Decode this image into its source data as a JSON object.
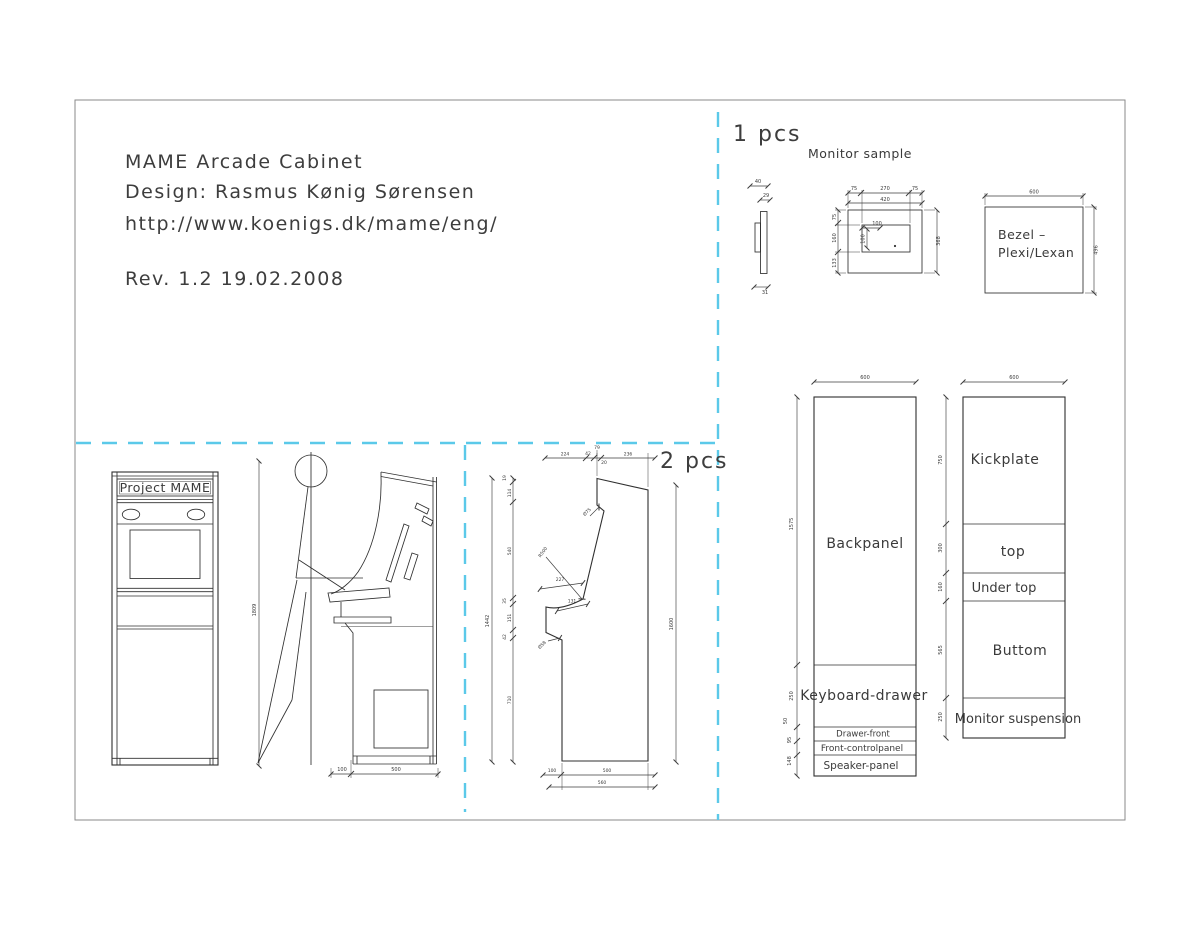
{
  "title_block": {
    "line1": "MAME Arcade Cabinet",
    "line2": "Design: Rasmus Kønig Sørensen",
    "line3": "http://www.koenigs.dk/mame/eng/",
    "revision": "Rev. 1.2   19.02.2008"
  },
  "section_labels": {
    "one_pcs": "1 pcs",
    "two_pcs": "2 pcs"
  },
  "monitor_sample": {
    "title": "Monitor sample",
    "profile_dims": [
      "40",
      "29",
      "31"
    ],
    "front": {
      "top_dims": [
        "75",
        "270",
        "75"
      ],
      "top_total": "420",
      "left_dims": [
        "75",
        "160",
        "133"
      ],
      "right_total": "368",
      "inner_width": "100",
      "inner_height": "100"
    }
  },
  "bezel": {
    "label_line1": "Bezel –",
    "label_line2": "Plexi/Lexan",
    "width_dim": "600",
    "height_dim": "496"
  },
  "front_view": {
    "marquee_text": "Project MAME",
    "height_dim": "1809"
  },
  "floor_dims": {
    "front_offset": "100",
    "depth": "500"
  },
  "side_panel": {
    "top_dims": [
      "224",
      "42",
      "79",
      "20",
      "236"
    ],
    "left_total": "1442",
    "left_dims": [
      "19",
      "114",
      "540",
      "35",
      "151",
      "42",
      "710"
    ],
    "right_total": "1600",
    "bottom_dims": [
      "100",
      "500"
    ],
    "bottom_total": "560",
    "callouts": {
      "marquee_groove": "Ø75",
      "radius": "R500",
      "cp_depth": "227",
      "cp_edge": "131",
      "notch": "Ø58"
    }
  },
  "panel_columns": {
    "left": {
      "width_dim": "600",
      "items": [
        {
          "label": "Backpanel",
          "height_dim": "1575"
        },
        {
          "label": "Keyboard-drawer",
          "height_dim": "250"
        },
        {
          "label": "Drawer-front",
          "height_dim": "50"
        },
        {
          "label": "Front-controlpanel",
          "height_dim": "95"
        },
        {
          "label": "Speaker-panel",
          "height_dim": "148"
        }
      ]
    },
    "right": {
      "width_dim": "600",
      "items": [
        {
          "label": "Kickplate",
          "height_dim": "750"
        },
        {
          "label": "top",
          "height_dim": "300"
        },
        {
          "label": "Under top",
          "height_dim": "160"
        },
        {
          "label": "Buttom",
          "height_dim": "565"
        },
        {
          "label": "Monitor suspension",
          "height_dim": "250"
        }
      ]
    }
  },
  "colors": {
    "line": "#2f2f2f",
    "dashed_divider": "#5bc9e9",
    "sheet_border": "#8a8a8a",
    "background": "#ffffff"
  }
}
